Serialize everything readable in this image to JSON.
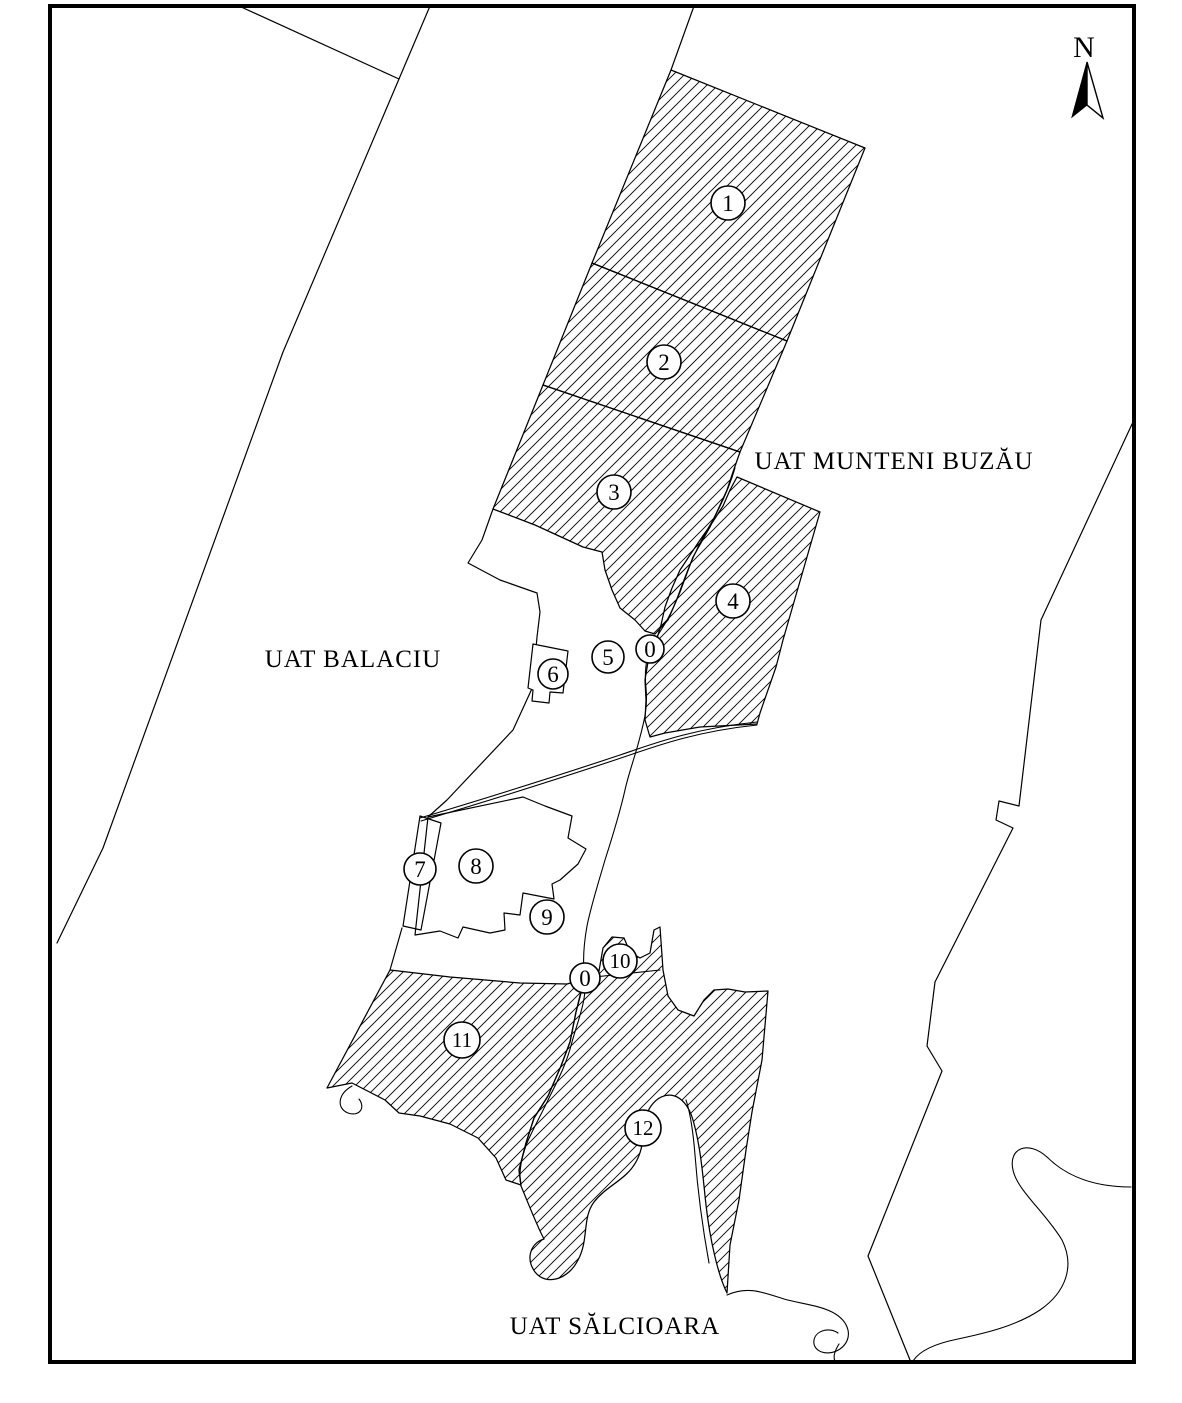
{
  "map": {
    "uat_labels": [
      {
        "name": "uat-munteni-buzau-label",
        "text": "UAT MUNTENI BUZĂU",
        "x": 894,
        "y": 469
      },
      {
        "name": "uat-balaciu-label",
        "text": "UAT BALACIU",
        "x": 353,
        "y": 667
      },
      {
        "name": "uat-salcioara-label",
        "text": "UAT SĂLCIOARA",
        "x": 615,
        "y": 1334
      }
    ],
    "north": {
      "label": "N",
      "x": 1084,
      "y": 57
    },
    "parcels": [
      {
        "number": "1",
        "cx": 728,
        "cy": 203,
        "r": 17
      },
      {
        "number": "2",
        "cx": 664,
        "cy": 362,
        "r": 17
      },
      {
        "number": "3",
        "cx": 614,
        "cy": 492,
        "r": 17
      },
      {
        "number": "4",
        "cx": 733,
        "cy": 601,
        "r": 17
      },
      {
        "number": "5",
        "cx": 608,
        "cy": 657,
        "r": 16
      },
      {
        "number": "0",
        "cx": 650,
        "cy": 649,
        "r": 14
      },
      {
        "number": "6",
        "cx": 553,
        "cy": 674,
        "r": 15
      },
      {
        "number": "7",
        "cx": 420,
        "cy": 869,
        "r": 16
      },
      {
        "number": "8",
        "cx": 476,
        "cy": 866,
        "r": 17
      },
      {
        "number": "9",
        "cx": 547,
        "cy": 917,
        "r": 17
      },
      {
        "number": "0",
        "cx": 585,
        "cy": 978,
        "r": 15
      },
      {
        "number": "10",
        "cx": 620,
        "cy": 961,
        "r": 17
      },
      {
        "number": "11",
        "cx": 462,
        "cy": 1040,
        "r": 18
      },
      {
        "number": "12",
        "cx": 643,
        "cy": 1128,
        "r": 18
      }
    ],
    "colors": {
      "ink": "#000000",
      "paper": "#ffffff"
    }
  }
}
